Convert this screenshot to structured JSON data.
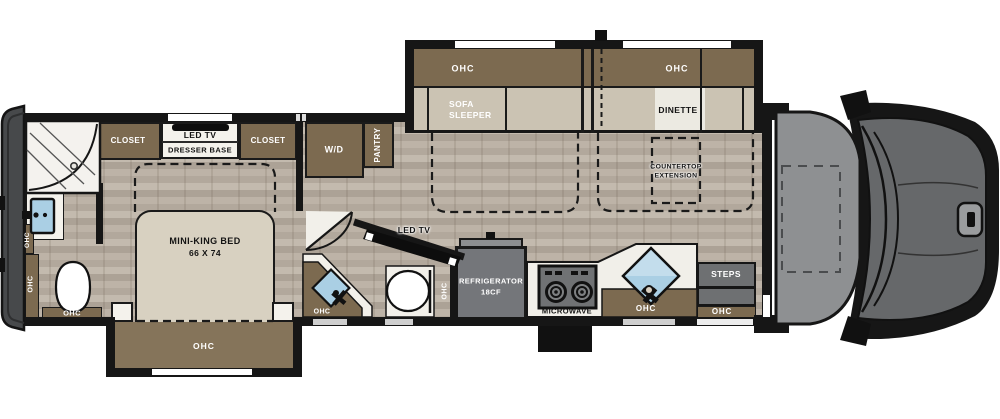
{
  "rear_bath": {
    "ohc_vanity": "OHC",
    "ohc_cabinet": "OHC",
    "ohc_base": "OHC"
  },
  "bedroom": {
    "closet_left": "CLOSET",
    "tv": "LED TV",
    "dresser": "DRESSER BASE",
    "closet_right": "CLOSET",
    "bed_title": "MINI-KING BED",
    "bed_size": "66 X 74",
    "slide_ohc": "OHC"
  },
  "utility": {
    "washer_dryer": "W/D",
    "pantry": "PANTRY"
  },
  "living": {
    "sofa_ohc": "OHC",
    "sofa_line1": "SOFA",
    "sofa_line2": "SLEEPER",
    "dinette_ohc": "OHC",
    "dinette": "DINETTE",
    "countertop_line1": "COUNTERTOP",
    "countertop_line2": "EXTENSION",
    "tv": "LED TV"
  },
  "half_bath": {
    "ohc_vanity": "OHC",
    "ohc_cabinet": "OHC"
  },
  "kitchen": {
    "fridge_line1": "REFRIGERATOR",
    "fridge_line2": "18CF",
    "microwave": "MICROWAVE",
    "sink_ohc": "OHC"
  },
  "entry": {
    "steps": "STEPS",
    "ohc": "OHC"
  },
  "colors": {
    "wall": "#161616",
    "cabinet_brown": "#7c6a50",
    "seat_tan": "#cbc3b3",
    "bed_tan": "#d8d1c1",
    "floor": "#b7ada1",
    "appliance_gray": "#6e7072",
    "sink_blue": "#aacfe4",
    "cab_gray": "#8e9092",
    "hood_gray": "#66686a",
    "slide_interior_brown": "#85745a"
  }
}
